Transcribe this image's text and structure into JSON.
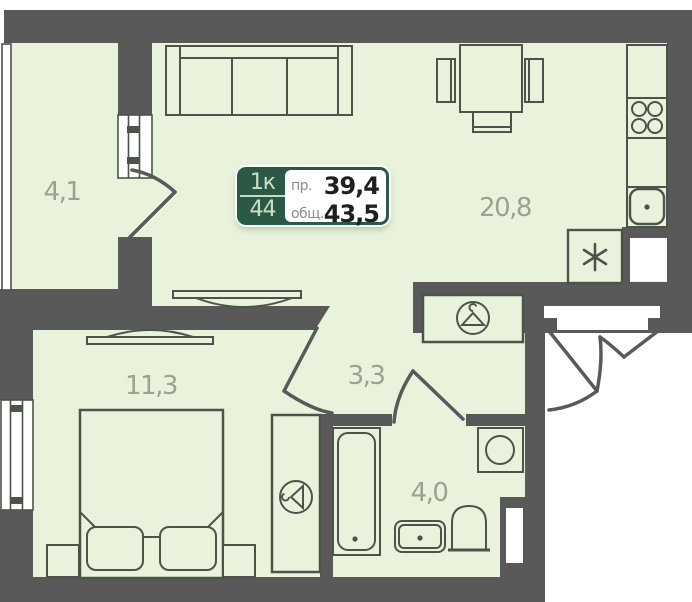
{
  "badge": {
    "rooms_short": "1к",
    "unit_number": "44",
    "project_area_label": "пр.",
    "project_area_value": "39,4",
    "total_area_label": "общ.",
    "total_area_value": "43,5"
  },
  "rooms": [
    {
      "name": "loggia",
      "area": "4,1"
    },
    {
      "name": "kitchen-living-room",
      "area": "20,8"
    },
    {
      "name": "bedroom",
      "area": "11,3"
    },
    {
      "name": "hallway",
      "area": "3,3"
    },
    {
      "name": "bathroom",
      "area": "4,0"
    }
  ],
  "icons": [
    "hanger-icon",
    "snowflake-icon",
    "stove-burners-icon",
    "sink-drain-icon",
    "washing-machine-drum-icon"
  ],
  "colors": {
    "wall": "#595959",
    "floor": "#e9f3dc",
    "furniture_line": "#4a544a",
    "room_label": "#9aa38f",
    "badge_green": "#2a5947",
    "badge_light_text": "#cde0c3",
    "badge_value_dark": "#1f1f1d",
    "badge_label_gray": "#8b8b89"
  }
}
